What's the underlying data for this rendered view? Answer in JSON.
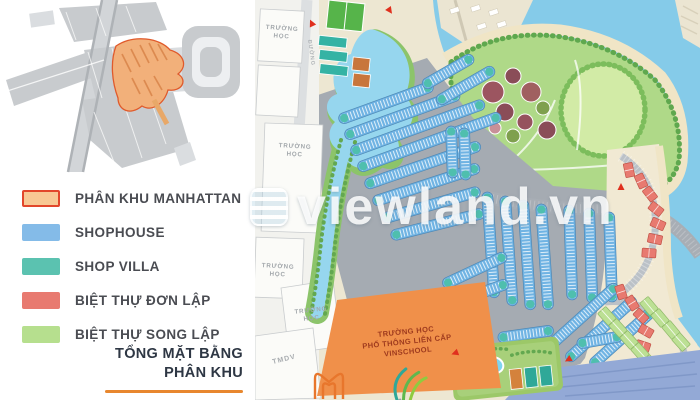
{
  "legend": {
    "items": [
      {
        "label": "PHÂN KHU MANHATTAN",
        "swatch_color": "#f8c894",
        "swatch_border": "#e2472b"
      },
      {
        "label": "SHOPHOUSE",
        "swatch_color": "#84bbe8",
        "swatch_border": "none"
      },
      {
        "label": "SHOP VILLA",
        "swatch_color": "#5bc2b0",
        "swatch_border": "none"
      },
      {
        "label": "BIỆT THỰ ĐƠN LẬP",
        "swatch_color": "#e87a70",
        "swatch_border": "none"
      },
      {
        "label": "BIỆT THỰ SONG LẬP",
        "swatch_color": "#b6df8e",
        "swatch_border": "none"
      }
    ]
  },
  "plan_title": {
    "line1": "TỔNG MẶT BẰNG",
    "line2": "PHÂN KHU",
    "underline_color": "#e8872e"
  },
  "map": {
    "watermark_text": "viewland.vn",
    "school_block_label": "TRƯỜNG HỌC",
    "road_label": "ĐƯỜNG",
    "commercial_label": "TMDV",
    "vinschool": {
      "line1": "TRƯỜNG HỌC",
      "line2": "PHỔ THÔNG LIÊN CẤP",
      "line3": "VINSCHOOL"
    },
    "colors": {
      "shophouse": "#6fb3e3",
      "shop_villa": "#4fbfae",
      "villa_don_lap": "#e87a70",
      "villa_song_lap": "#bce094",
      "school_orange": "#f0904a",
      "water": "#85cbe9",
      "park_green": "#afd988",
      "road_gray": "#a5abb2",
      "sand": "#f0e5c6",
      "arrow_red": "#e0301e"
    }
  },
  "minimap": {
    "highlight_color": "#f2b07a",
    "highlight_border": "#e05a2b"
  }
}
